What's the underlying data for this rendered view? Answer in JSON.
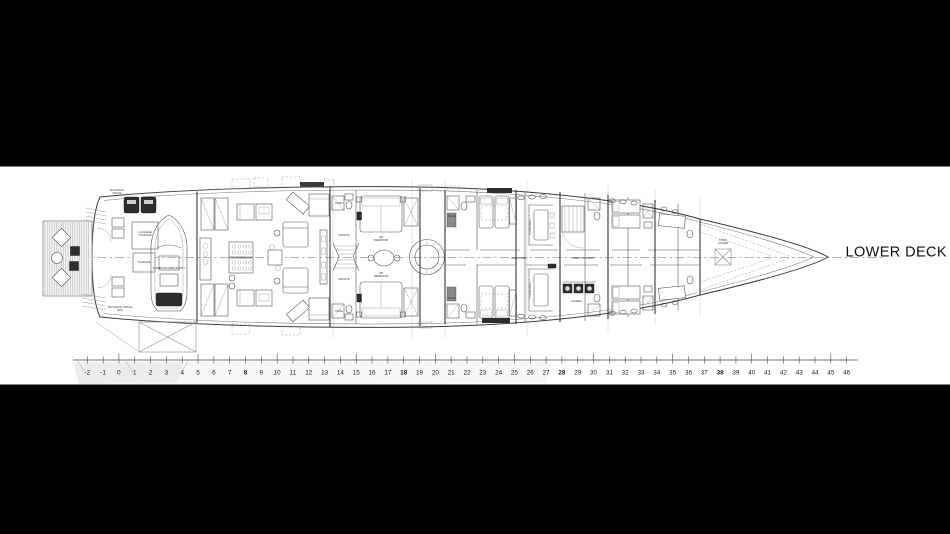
{
  "title": {
    "text": "LOWER DECK"
  },
  "colors": {
    "letterbox": "#000000",
    "sheet": "#ffffff",
    "ink": "#1a1a1a"
  },
  "plan": {
    "frame_scale": {
      "ticks": [
        -2,
        -1,
        0,
        1,
        2,
        3,
        4,
        5,
        6,
        7,
        8,
        9,
        10,
        11,
        12,
        13,
        14,
        15,
        16,
        17,
        18,
        19,
        20,
        21,
        22,
        23,
        24,
        25,
        26,
        27,
        28,
        29,
        30,
        31,
        32,
        33,
        34,
        35,
        36,
        37,
        38,
        39,
        40,
        41,
        42,
        43,
        44,
        45,
        46
      ],
      "emphasized": [
        8,
        18,
        28,
        38
      ]
    },
    "labels": [
      {
        "name": "technical-space-garage",
        "text": "TECHNICAL\nSPACE",
        "x": 117,
        "y": 191,
        "size": 2.7
      },
      {
        "name": "luggage-storage",
        "text": "LUGGAGE\nSTORAGE",
        "x": 145,
        "y": 233,
        "size": 2.7
      },
      {
        "name": "storage",
        "text": "STORAGE",
        "x": 144,
        "y": 263,
        "size": 2.7
      },
      {
        "name": "tender",
        "text": "TENDER W/ CREW SUPPLY",
        "x": 169,
        "y": 269,
        "size": 2.5
      },
      {
        "name": "technical-space-wc",
        "text": "TECHNICAL SPACE\n(WC)",
        "x": 120,
        "y": 308,
        "size": 2.7
      },
      {
        "name": "towel-top",
        "text": "TOWEL",
        "x": 339,
        "y": 204,
        "size": 2.4
      },
      {
        "name": "ensuite-top",
        "text": "ENSUITE",
        "x": 344,
        "y": 236,
        "size": 2.5
      },
      {
        "name": "ensuite-bottom",
        "text": "ENSUITE",
        "x": 344,
        "y": 280,
        "size": 2.5
      },
      {
        "name": "towel-bottom",
        "text": "TOWEL",
        "x": 339,
        "y": 312,
        "size": 2.4
      },
      {
        "name": "vip-bedroom-top",
        "text": "VIP\nBEDROOM",
        "x": 381,
        "y": 238,
        "size": 2.7
      },
      {
        "name": "vip-bedroom-bottom",
        "text": "VIP\nBEDROOM",
        "x": 381,
        "y": 274,
        "size": 2.7
      },
      {
        "name": "boiler-top",
        "text": "BOILER",
        "x": 452,
        "y": 217,
        "size": 2.3
      },
      {
        "name": "boiler-bottom",
        "text": "BOILER",
        "x": 452,
        "y": 299,
        "size": 2.3
      },
      {
        "name": "crew-mess-top",
        "text": "CREW MESS",
        "x": 531,
        "y": 227,
        "size": 2.5,
        "rot": -90
      },
      {
        "name": "crew-mess-bottom",
        "text": "CREW MESS",
        "x": 531,
        "y": 290,
        "size": 2.5,
        "rot": -90
      },
      {
        "name": "crew-cabin",
        "text": "CREW CABIN",
        "x": 519,
        "y": 259,
        "size": 2.5
      },
      {
        "name": "crew-corridor",
        "text": "CREW CORRIDOR",
        "x": 583,
        "y": 259,
        "size": 2.5
      },
      {
        "name": "laundry",
        "text": "LAUNDRY",
        "x": 577,
        "y": 302,
        "size": 2.4
      },
      {
        "name": "chain-locker",
        "text": "CHAIN\nLOCKER",
        "x": 723,
        "y": 241,
        "size": 2.5
      }
    ]
  }
}
